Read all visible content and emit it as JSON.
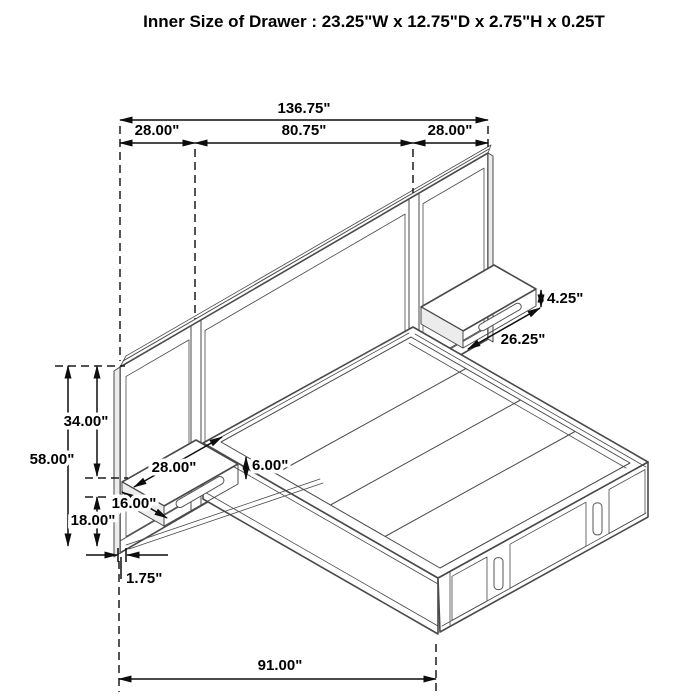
{
  "title": "Inner Size of Drawer : 23.25\"W x 12.75\"D x 2.75\"H x 0.25T",
  "dims": {
    "overall_width": "136.75\"",
    "left_section_width": "28.00\"",
    "center_section_width": "80.75\"",
    "right_section_width": "28.00\"",
    "headboard_height": "58.00\"",
    "upper_panel_height": "34.00\"",
    "lower_clearance": "18.00\"",
    "base_offset": "1.75\"",
    "overall_depth": "91.00\"",
    "left_shelf_width": "28.00\"",
    "left_shelf_depth": "16.00\"",
    "left_shelf_height": "6.00\"",
    "right_shelf_width": "26.25\"",
    "right_shelf_height": "4.25\""
  },
  "colors": {
    "line": "#4a4a4a",
    "slat_gray": "#9b9b9b",
    "drawer_gray": "#969696",
    "dimension": "#0d0d0d"
  }
}
